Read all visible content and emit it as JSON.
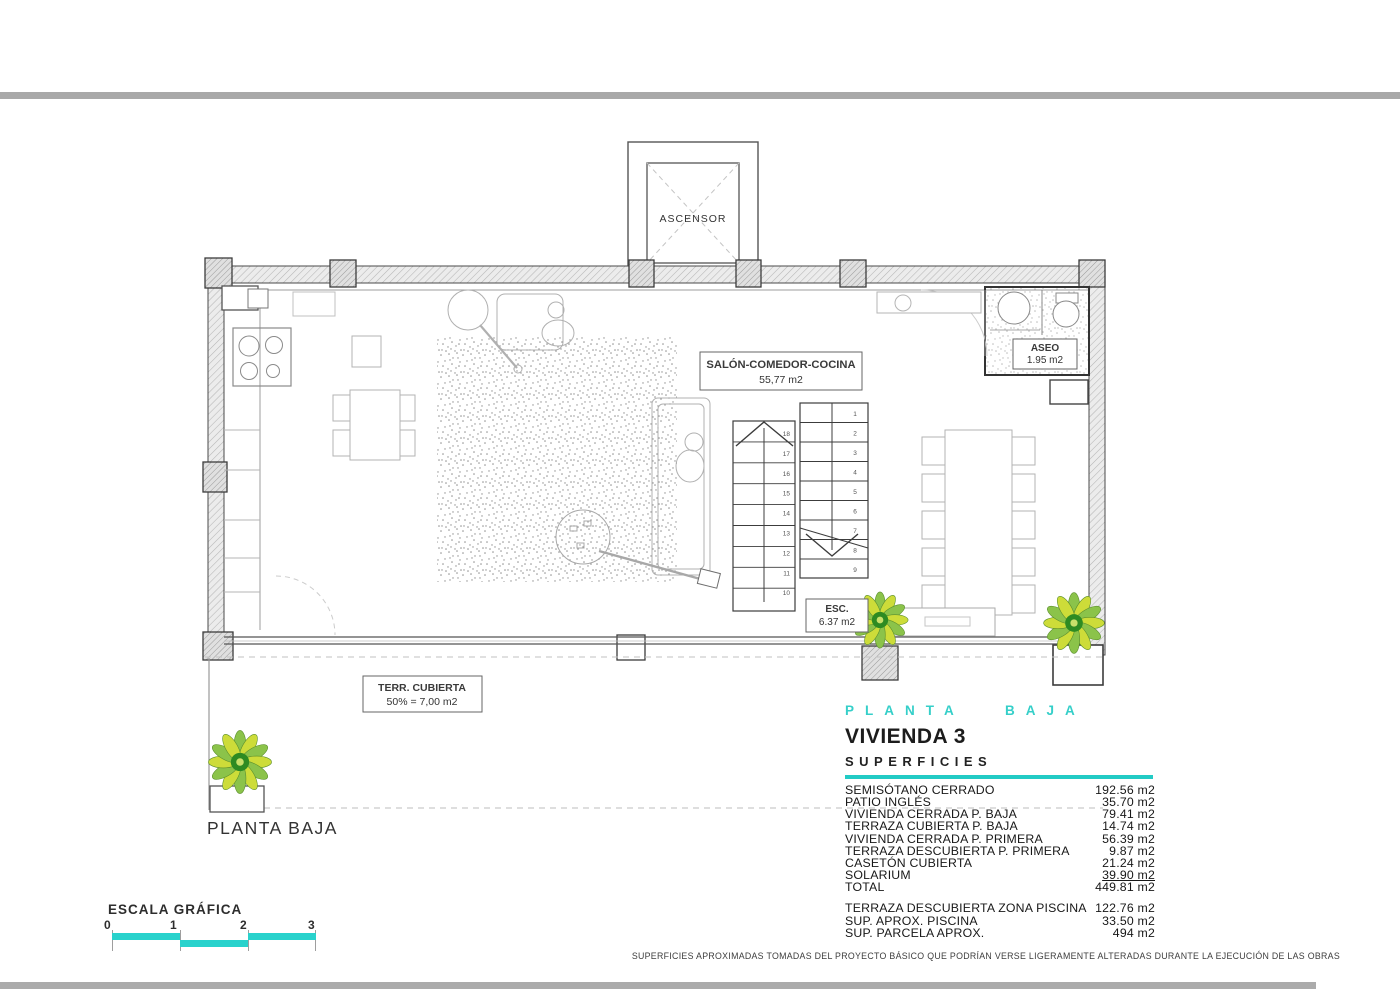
{
  "colors": {
    "accent_teal": "#29d2cc",
    "wall_line": "#4a4a4a"
  },
  "plan": {
    "ascensor_label": "ASCENSOR",
    "salon_line1": "SALÓN-COMEDOR-COCINA",
    "salon_line2": "55,77 m2",
    "aseo_line1": "ASEO",
    "aseo_line2": "1.95 m2",
    "esc_line1": "ESC.",
    "esc_line2": "6.37 m2",
    "terraza_line1": "TERR. CUBIERTA",
    "terraza_line2": "50% = 7,00 m2",
    "caption": "PLANTA BAJA",
    "stair_numbers_left": [
      "18",
      "17",
      "16",
      "15",
      "14",
      "13",
      "12",
      "11",
      "10"
    ],
    "stair_numbers_right": [
      "1",
      "2",
      "3",
      "4",
      "5",
      "6",
      "7",
      "8",
      "9"
    ]
  },
  "info": {
    "floor_title": "PLANTA BAJA",
    "unit_title": "VIVIENDA 3",
    "section_title": "SUPERFICIES",
    "rows": [
      {
        "label": "SEMISÓTANO CERRADO",
        "value": "192.56 m2"
      },
      {
        "label": "PATIO INGLÉS",
        "value": "35.70 m2"
      },
      {
        "label": "VIVIENDA CERRADA P. BAJA",
        "value": "79.41 m2"
      },
      {
        "label": "TERRAZA CUBIERTA P. BAJA",
        "value": "14.74 m2"
      },
      {
        "label": "VIVIENDA CERRADA P. PRIMERA",
        "value": "56.39 m2"
      },
      {
        "label": "TERRAZA DESCUBIERTA P. PRIMERA",
        "value": "9.87 m2"
      },
      {
        "label": "CASETÓN CUBIERTA",
        "value": "21.24 m2"
      },
      {
        "label": "SOLARIUM",
        "value": "39.90 m2",
        "underline": true
      },
      {
        "label": "TOTAL",
        "value": "449.81 m2"
      }
    ],
    "rows2": [
      {
        "label": "TERRAZA DESCUBIERTA  ZONA PISCINA",
        "value": "122.76 m2"
      },
      {
        "label": "SUP.  APROX.  PISCINA",
        "value": "33.50 m2"
      },
      {
        "label": "SUP. PARCELA APROX.",
        "value": "494 m2"
      }
    ]
  },
  "scale": {
    "title": "ESCALA GRÁFICA",
    "ticks": [
      "0",
      "1",
      "2",
      "3"
    ]
  },
  "disclaimer": "SUPERFICIES APROXIMADAS TOMADAS DEL PROYECTO BÁSICO QUE PODRÍAN VERSE LIGERAMENTE ALTERADAS DURANTE LA EJECUCIÓN DE LAS OBRAS"
}
